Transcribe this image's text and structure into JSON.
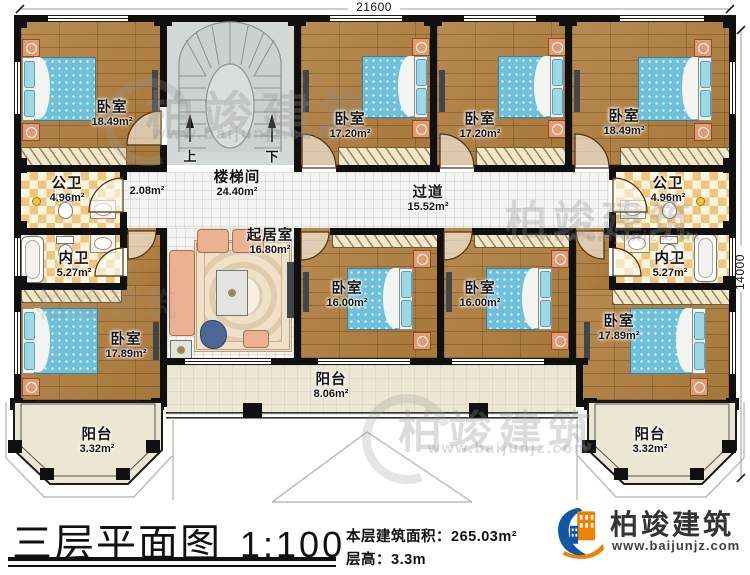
{
  "plan": {
    "dim_top": "21600",
    "dim_right": "14000",
    "stairs": {
      "up": "上",
      "down": "下"
    },
    "rooms": {
      "bedroom_tl": {
        "name": "卧室",
        "area": "18.49m²"
      },
      "bedroom_t2": {
        "name": "卧室",
        "area": "17.20m²"
      },
      "bedroom_t3": {
        "name": "卧室",
        "area": "17.20m²"
      },
      "bedroom_tr": {
        "name": "卧室",
        "area": "18.49m²"
      },
      "stairwell": {
        "name": "楼梯间",
        "area": "24.40m²"
      },
      "corridor": {
        "name": "过道",
        "area": "15.52m²"
      },
      "vestibule": {
        "area": "2.08m²"
      },
      "public_bath_left": {
        "name": "公卫",
        "area": "4.96m²"
      },
      "public_bath_right": {
        "name": "公卫",
        "area": "4.96m²"
      },
      "private_bath_left": {
        "name": "内卫",
        "area": "5.27m²"
      },
      "private_bath_right": {
        "name": "内卫",
        "area": "5.27m²"
      },
      "living_room": {
        "name": "起居室",
        "area": "16.80m²"
      },
      "bedroom_bm1": {
        "name": "卧室",
        "area": "16.00m²"
      },
      "bedroom_bm2": {
        "name": "卧室",
        "area": "16.00m²"
      },
      "bedroom_bl": {
        "name": "卧室",
        "area": "17.89m²"
      },
      "bedroom_br": {
        "name": "卧室",
        "area": "17.89m²"
      },
      "balcony_left": {
        "name": "阳台",
        "area": "3.32m²"
      },
      "balcony_center": {
        "name": "阳台",
        "area": "8.06m²"
      },
      "balcony_right": {
        "name": "阳台",
        "area": "3.32m²"
      }
    }
  },
  "titleblock": {
    "title": "三层平面图",
    "scale": "1:100",
    "floor_area_label": "本层建筑面积：",
    "floor_area_value": "265.03m²",
    "floor_height_label": "层高：",
    "floor_height_value": "3.3m"
  },
  "brand": {
    "name": "柏竣建筑",
    "website": "www.baijunjz.com"
  },
  "watermark": {
    "text": "柏竣建筑",
    "url": "www.baijunjz.com"
  }
}
